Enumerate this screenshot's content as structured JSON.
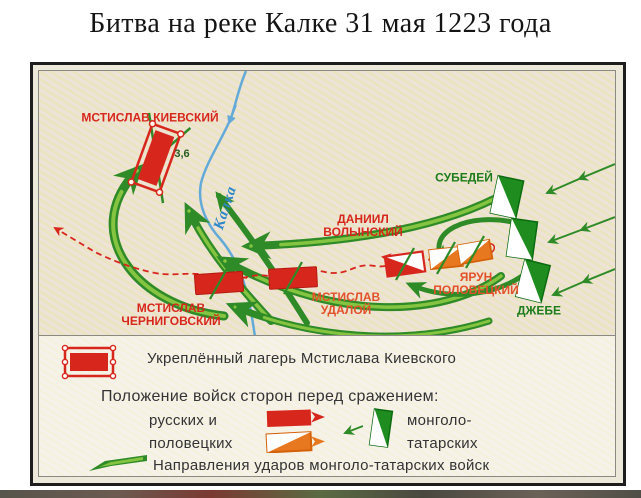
{
  "title": "Битва на реке Калке 31 мая 1223 года",
  "map": {
    "river_label": "Калка",
    "camp_strength": "3,6",
    "labels": {
      "mstislav_kievsky": "МСТИСЛАВ КИЕВСКИЙ",
      "subedei": "СУБЕДЕЙ",
      "daniil_volynsky": "ДАНИИЛ\nВОЛЫНСКИЙ",
      "yarun_polovetsky": "ЯРУН\nПОЛОВЕЦКИЙ",
      "jebe": "ДЖЕБЕ",
      "mstislav_udaloy": "МСТИСЛАВ\nУДАЛОЙ",
      "mstislav_chernigovsky": "МСТИСЛАВ\nЧЕРНИГОВСКИЙ"
    }
  },
  "legend": {
    "camp_label": "Укреплённый лагерь Мстислава Киевского",
    "positions_heading": "Положение войск сторон перед сражением:",
    "rus_polov_label": "русских и\nполовецких",
    "mongol_label": "монголо-\nтатарских",
    "attacks_label": "Направления ударов монголо-татарских войск"
  },
  "colors": {
    "red": "#d7271d",
    "orange": "#e8781f",
    "green_dark": "#2e8b27",
    "green_light": "#85c440",
    "green_text": "#1d7c1b",
    "river_blue": "#64aad8",
    "map_bg": "#ebe6d6",
    "legend_bg": "#f6f4ea"
  }
}
